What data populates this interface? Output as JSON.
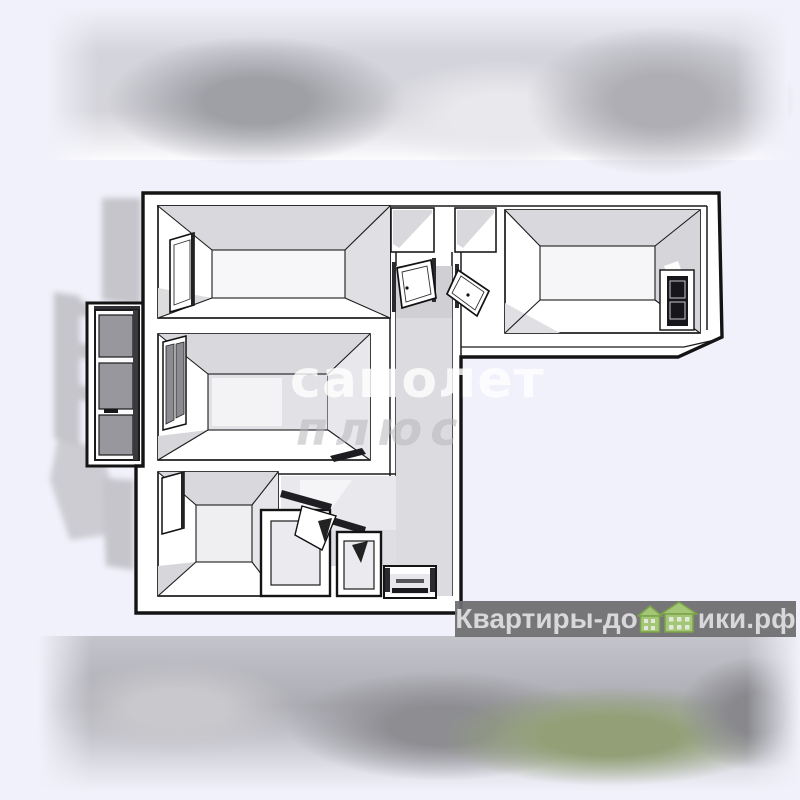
{
  "page": {
    "background_color": "#f1f1fb"
  },
  "photo": {
    "type": "apartment-3d-floorplan-render",
    "watermark_center": {
      "line1": "самолет",
      "line2": "плюс"
    },
    "brand_watermark": {
      "prefix": "Квартиры-до",
      "suffix": "ики.рф",
      "letter_replaced_by_houses": "м",
      "band_color": "#6d6d71",
      "text_color": "#d8d8da",
      "house_fill": "#a3c776",
      "house_outline": "#7ba24a"
    },
    "floorplan_colors": {
      "lines": "#1b1b1b",
      "walls": "#ffffff",
      "floor_shade": "#d9d9dd",
      "shadow": "#c5c5cb",
      "glass": "#97979d"
    }
  }
}
